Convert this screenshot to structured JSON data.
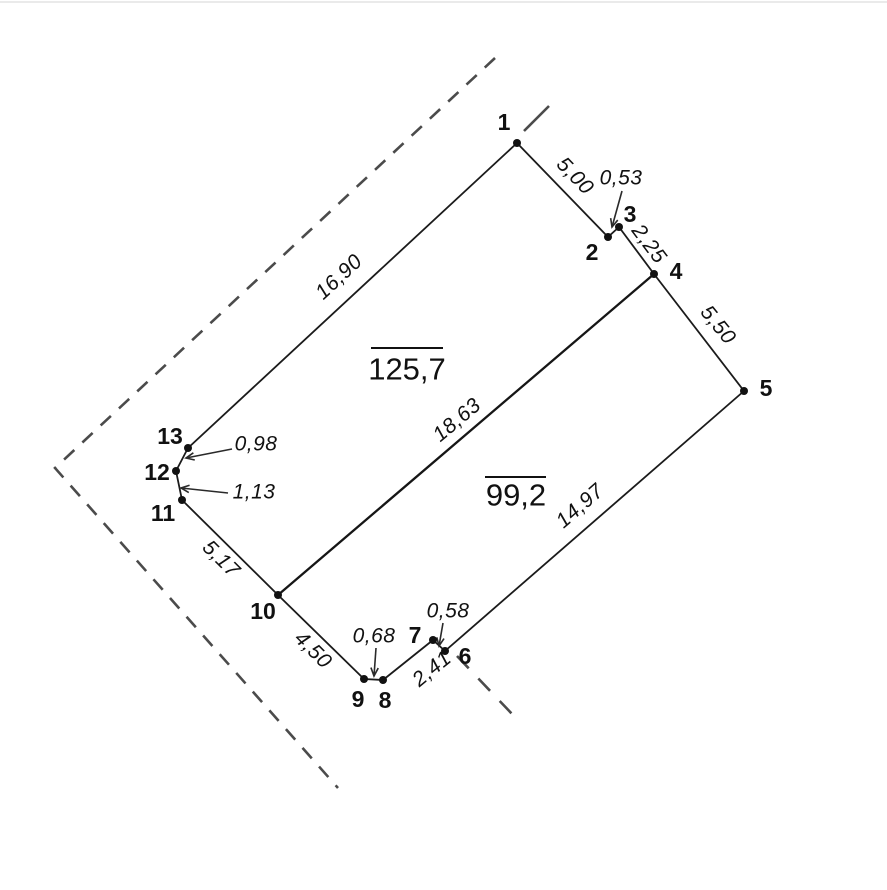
{
  "canvas": {
    "width": 887,
    "height": 890,
    "background": "#ffffff",
    "top_border": {
      "y": 2,
      "color": "#e3e3e3",
      "width": 1.5
    }
  },
  "style": {
    "boundary_color": "#1b1b1b",
    "boundary_width": 1.8,
    "divider_color": "#161616",
    "divider_width": 2.3,
    "dashed_color": "#4b4b4b",
    "dashed_width": 2.6,
    "dash_pattern": "14 11",
    "point_color": "#111111",
    "point_radius": 4,
    "text_color": "#111111",
    "arrow_color": "#2a2a2a",
    "arrow_width": 1.6,
    "arrow_head_size": 9,
    "overline_width": 2
  },
  "plan": {
    "points": [
      {
        "id": "1",
        "x": 517,
        "y": 143,
        "lx": 504,
        "ly": 122
      },
      {
        "id": "2",
        "x": 608,
        "y": 237,
        "lx": 592,
        "ly": 252
      },
      {
        "id": "3",
        "x": 619,
        "y": 227,
        "lx": 630,
        "ly": 214
      },
      {
        "id": "4",
        "x": 654,
        "y": 274,
        "lx": 676,
        "ly": 271
      },
      {
        "id": "5",
        "x": 744,
        "y": 391,
        "lx": 766,
        "ly": 388
      },
      {
        "id": "6",
        "x": 445,
        "y": 651,
        "lx": 465,
        "ly": 656
      },
      {
        "id": "7",
        "x": 433,
        "y": 640,
        "lx": 415,
        "ly": 635
      },
      {
        "id": "8",
        "x": 383,
        "y": 680,
        "lx": 385,
        "ly": 700
      },
      {
        "id": "9",
        "x": 364,
        "y": 679,
        "lx": 358,
        "ly": 699
      },
      {
        "id": "10",
        "x": 278,
        "y": 595,
        "lx": 263,
        "ly": 611
      },
      {
        "id": "11",
        "x": 182,
        "y": 500,
        "lx": 163,
        "ly": 513
      },
      {
        "id": "12",
        "x": 176,
        "y": 471,
        "lx": 157,
        "ly": 472
      },
      {
        "id": "13",
        "x": 188,
        "y": 448,
        "lx": 170,
        "ly": 436
      }
    ],
    "boundary": [
      "1",
      "2",
      "3",
      "4",
      "5",
      "6",
      "7",
      "8",
      "9",
      "10",
      "11",
      "12",
      "13",
      "1"
    ],
    "divider": {
      "from": "4",
      "to": "10"
    },
    "edge_labels": [
      {
        "text": "5,00",
        "x": 575,
        "y": 176,
        "rot": 46
      },
      {
        "text": "2,25",
        "x": 649,
        "y": 244,
        "rot": 53
      },
      {
        "text": "5,50",
        "x": 718,
        "y": 325,
        "rot": 51
      },
      {
        "text": "14,97",
        "x": 580,
        "y": 506,
        "rot": -41
      },
      {
        "text": "2,41",
        "x": 432,
        "y": 669,
        "rot": -39
      },
      {
        "text": "4,50",
        "x": 313,
        "y": 650,
        "rot": 45
      },
      {
        "text": "5,17",
        "x": 221,
        "y": 559,
        "rot": 45
      },
      {
        "text": "16,90",
        "x": 339,
        "y": 277,
        "rot": -43
      },
      {
        "text": "18,63",
        "x": 457,
        "y": 420,
        "rot": -40
      }
    ],
    "leader_labels": [
      {
        "text": "0,53",
        "x": 621,
        "y": 178,
        "ax1": 622,
        "ay1": 191,
        "ax2": 612,
        "ay2": 227
      },
      {
        "text": "0,58",
        "x": 448,
        "y": 611,
        "ax1": 443,
        "ay1": 623,
        "ax2": 439,
        "ay2": 646
      },
      {
        "text": "0,68",
        "x": 374,
        "y": 636,
        "ax1": 376,
        "ay1": 648,
        "ax2": 374,
        "ay2": 676
      },
      {
        "text": "0,98",
        "x": 256,
        "y": 444,
        "ax1": 232,
        "ay1": 449,
        "ax2": 186,
        "ay2": 458
      },
      {
        "text": "1,13",
        "x": 254,
        "y": 492,
        "ax1": 228,
        "ay1": 493,
        "ax2": 181,
        "ay2": 488
      }
    ],
    "area_labels": [
      {
        "text": "125,7",
        "x": 407,
        "y": 369,
        "ox1": 371,
        "ox2": 443,
        "oy": 348
      },
      {
        "text": "99,2",
        "x": 516,
        "y": 495,
        "ox1": 485,
        "ox2": 546,
        "oy": 477
      }
    ],
    "dashed_polylines": [
      {
        "name": "outer-boundary-dashed",
        "points": [
          [
            495,
            58
          ],
          [
            55,
            468
          ],
          [
            338,
            788
          ]
        ]
      },
      {
        "name": "extension-dash-point-1",
        "points": [
          [
            524,
            131
          ],
          [
            549,
            106
          ]
        ],
        "solid": true
      },
      {
        "name": "extension-dash-point-6",
        "points": [
          [
            457,
            656
          ],
          [
            513,
            715
          ]
        ],
        "pattern": "17 14"
      }
    ]
  }
}
